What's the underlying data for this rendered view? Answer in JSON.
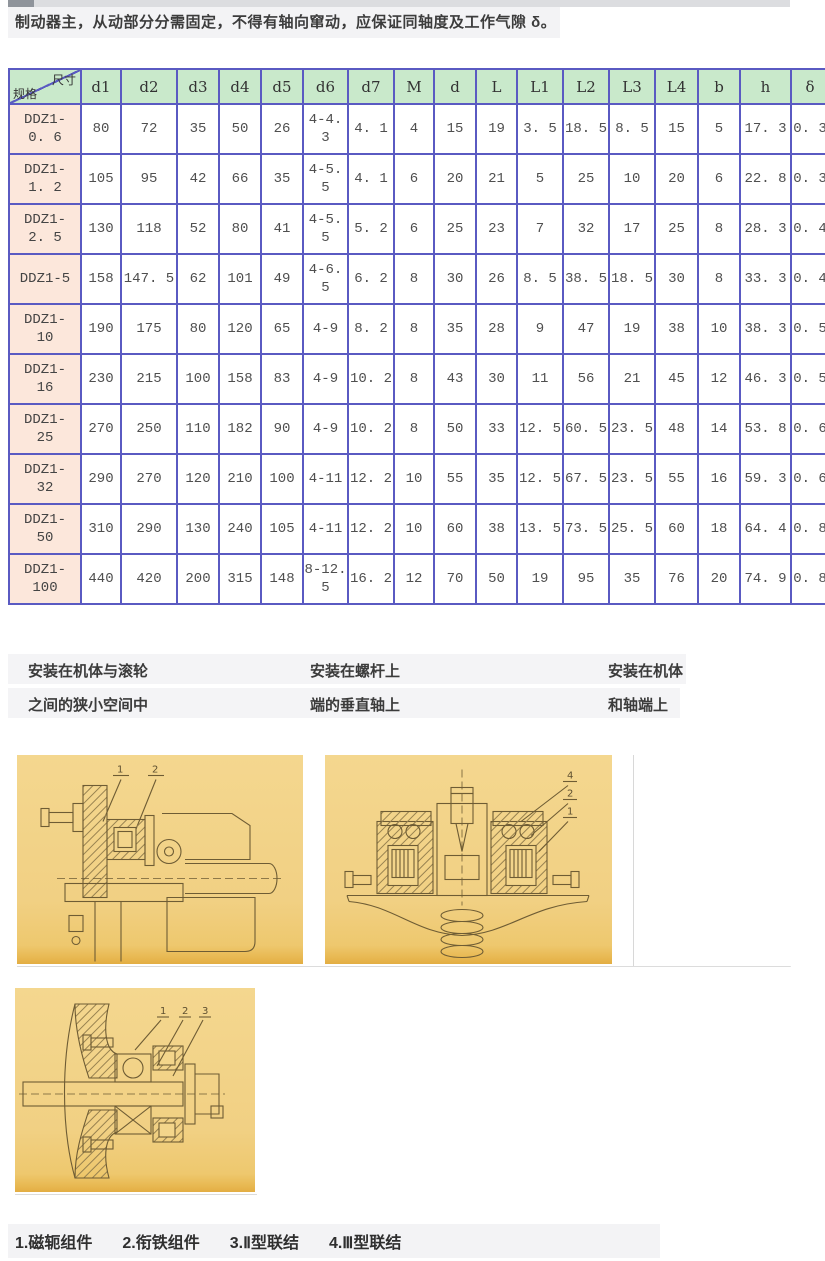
{
  "headline": {
    "text": "制动器主，从动部分分需固定，不得有轴向窜动，应保证同轴度及工作气隙 δ。"
  },
  "spec_table": {
    "corner_top": "尺寸",
    "corner_bottom": "规格",
    "columns": [
      "d1",
      "d2",
      "d3",
      "d4",
      "d5",
      "d6",
      "d7",
      "M",
      "d",
      "L",
      "L1",
      "L2",
      "L3",
      "L4",
      "b",
      "h",
      "δ"
    ],
    "rows": [
      {
        "model": "DDZ1-0. 6",
        "values": [
          "80",
          "72",
          "35",
          "50",
          "26",
          "4-4. 3",
          "4. 1",
          "4",
          "15",
          "19",
          "3. 5",
          "18. 5",
          "8. 5",
          "15",
          "5",
          "17. 3",
          "0. 3"
        ]
      },
      {
        "model": "DDZ1-1. 2",
        "values": [
          "105",
          "95",
          "42",
          "66",
          "35",
          "4-5. 5",
          "4. 1",
          "6",
          "20",
          "21",
          "5",
          "25",
          "10",
          "20",
          "6",
          "22. 8",
          "0. 3"
        ]
      },
      {
        "model": "DDZ1-2. 5",
        "values": [
          "130",
          "118",
          "52",
          "80",
          "41",
          "4-5. 5",
          "5. 2",
          "6",
          "25",
          "23",
          "7",
          "32",
          "17",
          "25",
          "8",
          "28. 3",
          "0. 4"
        ]
      },
      {
        "model": "DDZ1-5",
        "values": [
          "158",
          "147. 5",
          "62",
          "101",
          "49",
          "4-6. 5",
          "6. 2",
          "8",
          "30",
          "26",
          "8. 5",
          "38. 5",
          "18. 5",
          "30",
          "8",
          "33. 3",
          "0. 4"
        ]
      },
      {
        "model": "DDZ1-10",
        "values": [
          "190",
          "175",
          "80",
          "120",
          "65",
          "4-9",
          "8. 2",
          "8",
          "35",
          "28",
          "9",
          "47",
          "19",
          "38",
          "10",
          "38. 3",
          "0. 5"
        ]
      },
      {
        "model": "DDZ1-16",
        "values": [
          "230",
          "215",
          "100",
          "158",
          "83",
          "4-9",
          "10. 2",
          "8",
          "43",
          "30",
          "11",
          "56",
          "21",
          "45",
          "12",
          "46. 3",
          "0. 5"
        ]
      },
      {
        "model": "DDZ1-25",
        "values": [
          "270",
          "250",
          "110",
          "182",
          "90",
          "4-9",
          "10. 2",
          "8",
          "50",
          "33",
          "12. 5",
          "60. 5",
          "23. 5",
          "48",
          "14",
          "53. 8",
          "0. 6"
        ]
      },
      {
        "model": "DDZ1-32",
        "values": [
          "290",
          "270",
          "120",
          "210",
          "100",
          "4-11",
          "12. 2",
          "10",
          "55",
          "35",
          "12. 5",
          "67. 5",
          "23. 5",
          "55",
          "16",
          "59. 3",
          "0. 6"
        ]
      },
      {
        "model": "DDZ1-50",
        "values": [
          "310",
          "290",
          "130",
          "240",
          "105",
          "4-11",
          "12. 2",
          "10",
          "60",
          "38",
          "13. 5",
          "73. 5",
          "25. 5",
          "60",
          "18",
          "64. 4",
          "0. 8"
        ]
      },
      {
        "model": "DDZ1-100",
        "values": [
          "440",
          "420",
          "200",
          "315",
          "148",
          "8-12. 5",
          "16. 2",
          "12",
          "70",
          "50",
          "19",
          "95",
          "35",
          "76",
          "20",
          "74. 9",
          "0. 8"
        ]
      }
    ]
  },
  "mount_captions": [
    {
      "line1": "安装在机体与滚轮",
      "line2": "之间的狭小空间中"
    },
    {
      "line1": "安装在螺杆上",
      "line2": "端的垂直轴上"
    },
    {
      "line1": "安装在机体",
      "line2": "和轴端上"
    }
  ],
  "figures": [
    {
      "part_labels": [
        "1",
        "2"
      ]
    },
    {
      "part_labels": [
        "4",
        "2",
        "1"
      ]
    },
    {
      "part_labels": [
        "1",
        "2",
        "3"
      ]
    }
  ],
  "legend": {
    "items": [
      "1.磁轭组件",
      "2.衔铁组件",
      "3.Ⅱ型联结",
      "4.Ⅲ型联结"
    ]
  },
  "colors": {
    "table_border": "#5a5ac2",
    "table_header_green": "#c9e9cb",
    "model_column_pink": "#fce7db",
    "figure_background_tan": "#f2d182",
    "gray_bar": "#f3f3f5"
  }
}
